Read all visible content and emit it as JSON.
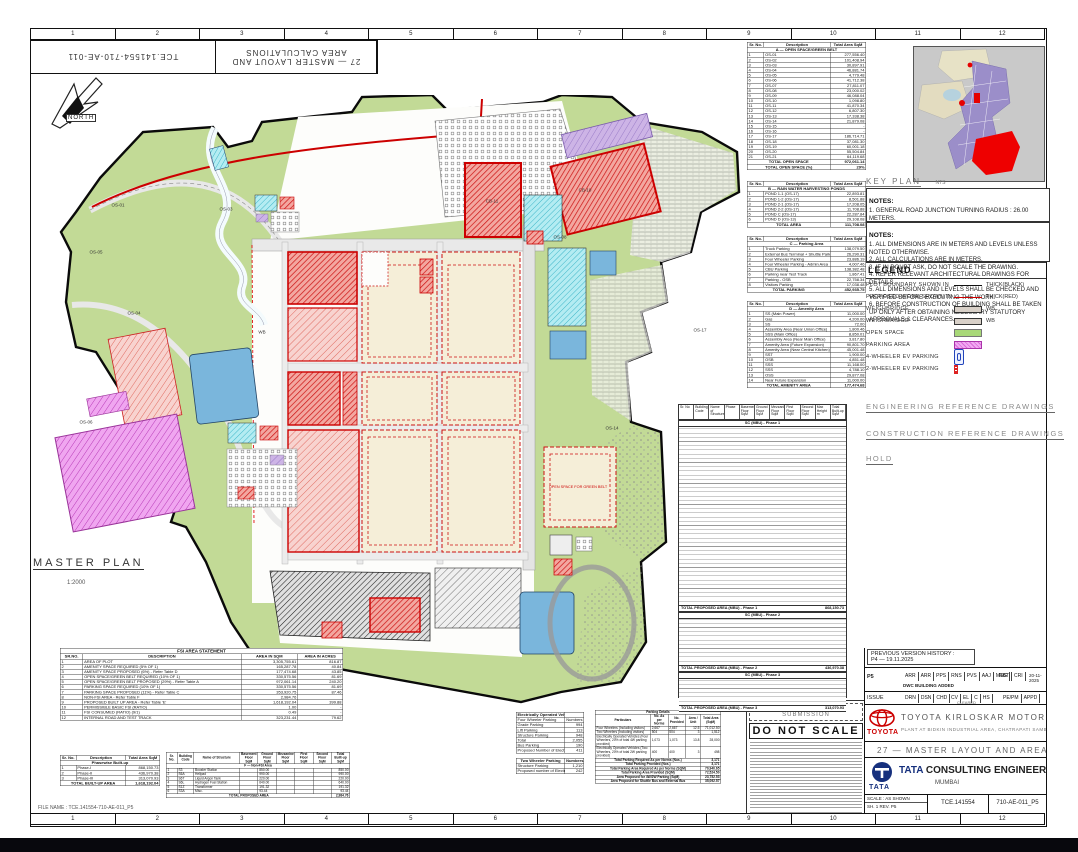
{
  "sheet": {
    "ruler_numbers": [
      "1",
      "2",
      "3",
      "4",
      "5",
      "6",
      "7",
      "8",
      "9",
      "10",
      "11",
      "12"
    ],
    "flip_left": "TCE.141554-710-AE-011",
    "flip_right_line1": "27 — MASTER LAYOUT AND",
    "flip_right_line2": "AREA CALCULATIONS",
    "corner_note": "21.512",
    "north_label": "NORTH"
  },
  "plan": {
    "title": "MASTER PLAN",
    "scale": "1:2000",
    "labels": [
      {
        "t": "OS-01",
        "x": 118,
        "y": 205,
        "c": ""
      },
      {
        "t": "OS-03",
        "x": 226,
        "y": 209,
        "c": ""
      },
      {
        "t": "OS-05",
        "x": 96,
        "y": 252,
        "c": ""
      },
      {
        "t": "OS-04",
        "x": 134,
        "y": 313,
        "c": ""
      },
      {
        "t": "OS-06",
        "x": 86,
        "y": 422,
        "c": ""
      },
      {
        "t": "CB-11",
        "x": 492,
        "y": 201,
        "c": ""
      },
      {
        "t": "CB-10",
        "x": 585,
        "y": 190,
        "c": ""
      },
      {
        "t": "OS-08",
        "x": 560,
        "y": 237,
        "c": ""
      },
      {
        "t": "OS-14",
        "x": 612,
        "y": 428,
        "c": ""
      },
      {
        "t": "OS-17",
        "x": 700,
        "y": 330,
        "c": ""
      },
      {
        "t": "WB",
        "x": 262,
        "y": 332,
        "c": ""
      },
      {
        "t": "OPEN SPACE FOR GREEN BELT",
        "x": 578,
        "y": 487,
        "c": "red"
      }
    ]
  },
  "colors": {
    "open_space": "#a8d878",
    "parking_area": "#ee82ee",
    "proposed_red": "#cc0000",
    "water": "#6ab0d8",
    "plot_beige": "#f5eed8",
    "key_urban": "#9b8ec9"
  },
  "tableA": {
    "head": [
      "Sr. No.",
      "Description",
      "Total Area SqM"
    ],
    "widths": [
      14,
      56,
      30
    ],
    "rows": [
      [
        "§",
        "A — OPEN SPACE/GREEN BELT"
      ],
      [
        "1",
        "OS-01",
        "277,556.40"
      ],
      [
        "2",
        "OS-02",
        "101,408.94"
      ],
      [
        "3",
        "OS-03",
        "30,897.91"
      ],
      [
        "4",
        "OS-04",
        "46,881.74"
      ],
      [
        "5",
        "OS-05",
        "4,779.48"
      ],
      [
        "6",
        "OS-06",
        "41,712.38"
      ],
      [
        "7",
        "OS-07",
        "27,811.07"
      ],
      [
        "8",
        "OS-08",
        "23,000.02"
      ],
      [
        "9",
        "OS-09",
        "46,088.04"
      ],
      [
        "10",
        "OS-10",
        "1,098.80"
      ],
      [
        "11",
        "OS-11",
        "41,870.34"
      ],
      [
        "12",
        "OS-12",
        "6,807.30"
      ],
      [
        "13",
        "OS-13",
        "17,338.38"
      ],
      [
        "14",
        "OS-14",
        "21,879.08"
      ],
      [
        "15",
        "OS-15",
        "-"
      ],
      [
        "16",
        "OS-16",
        "-"
      ],
      [
        "17",
        "OS-17",
        "186,714.71"
      ],
      [
        "18",
        "OS-18",
        "37,081.30"
      ],
      [
        "19",
        "OS-19",
        "60,001.18"
      ],
      [
        "20",
        "OS-20",
        "55,504.84"
      ],
      [
        "21",
        "OS-21",
        "64,119.68"
      ],
      [
        "Σ",
        "TOTAL OPEN SPACE",
        "972,061.14"
      ],
      [
        "Σ",
        "TOTAL OPEN SPACE (%)",
        "29%"
      ]
    ]
  },
  "tableB": {
    "head": [
      "Sr. No.",
      "Description",
      "Total Area SqM"
    ],
    "widths": [
      14,
      56,
      30
    ],
    "rows": [
      [
        "§",
        "B — RAIN WATER HARVESTING PONDS"
      ],
      [
        "1",
        "POND 1-1 (OS-17)",
        "22,893.81"
      ],
      [
        "2",
        "POND 1-2 (OS-17)",
        "8,501.88"
      ],
      [
        "3",
        "POND 2-1 (OS-17)",
        "17,208.05"
      ],
      [
        "4",
        "POND 2-2 (OS-17)",
        "11,708.88"
      ],
      [
        "5",
        "POND C (OS-17)",
        "22,287.84"
      ],
      [
        "6",
        "POND D (OS-13)",
        "29,108.08"
      ],
      [
        "Σ",
        "TOTAL AREA",
        "111,708.08"
      ]
    ]
  },
  "tableC": {
    "head": [
      "Sr. No.",
      "Description",
      "Total Area SqM"
    ],
    "widths": [
      14,
      56,
      30
    ],
    "rows": [
      [
        "§",
        "C — Parking Area"
      ],
      [
        "1",
        "Truck Parking",
        "138,079.50"
      ],
      [
        "2",
        "External Bus Terminal + Shuttle Parking",
        "26,290.31"
      ],
      [
        "3",
        "Four Wheeler Parking",
        "23,886.19"
      ],
      [
        "4",
        "Four Wheeler Parking - Admin Area",
        "4,007.46"
      ],
      [
        "5",
        "CBU Parking",
        "138,382.48"
      ],
      [
        "6",
        "Parking near Test Track",
        "1,867.41"
      ],
      [
        "7",
        "Parking - OSB",
        "22,758.34"
      ],
      [
        "8",
        "Visitors Parking",
        "17,038.48"
      ],
      [
        "Σ",
        "TOTAL PARKING",
        "452,935.75"
      ]
    ]
  },
  "tableD": {
    "head": [
      "Sr. No.",
      "Description",
      "Total Area SqM"
    ],
    "widths": [
      14,
      56,
      30
    ],
    "rows": [
      [
        "§",
        "D — Amenity Area"
      ],
      [
        "1",
        "SS (Main Power)",
        "11,000.00"
      ],
      [
        "2",
        "Gas",
        "4,200.00"
      ],
      [
        "3",
        "SS",
        "72.00"
      ],
      [
        "4",
        "Assembly Area (Near Union Office)",
        "1,800.46"
      ],
      [
        "5",
        "SSS (Main Office)",
        "8,850.01"
      ],
      [
        "6",
        "Assembly Area (Near Main Office)",
        "3,817.80"
      ],
      [
        "7",
        "Amenity Area (Future Expansion)",
        "90,801.70"
      ],
      [
        "8",
        "Amenity Area (Near Central Kitchen)",
        "45,001.48"
      ],
      [
        "9",
        "SST",
        "1,900.00"
      ],
      [
        "10",
        "OSB",
        "4,851.48"
      ],
      [
        "11",
        "SSS",
        "11,168.00"
      ],
      [
        "12",
        "SSS",
        "4,788.10"
      ],
      [
        "13",
        "OSS",
        "29,877.08"
      ],
      [
        "14",
        "Near Future Expansion",
        "11,000.00"
      ],
      [
        "Σ",
        "TOTAL AMENITY AREA",
        "177,474.68"
      ]
    ]
  },
  "fsi": {
    "title": "FSI AREA STATEMENT",
    "head": [
      "SR.NO.",
      "DESCRIPTION",
      "AREA IN SQM",
      "AREA IN ACRES"
    ],
    "widths": [
      8,
      56,
      20,
      16
    ],
    "rows": [
      [
        "1",
        "AREA OF PLOT",
        "3,305,755.61",
        "816.87"
      ],
      [
        "2",
        "AMENITY SPACE REQUIRED (5% OF 1)",
        "165,287.78",
        "40.84"
      ],
      [
        "3",
        "AMENITY SPACE PROPOSED (6%) - Refer Table D",
        "177,474.68",
        "43.85"
      ],
      [
        "4",
        "OPEN SPACE/GREEN BELT REQUIRED (10% OF 1)",
        "330,575.56",
        "81.69"
      ],
      [
        "5",
        "OPEN SPACE/GREEN BELT PROPOSED (29%) - Refer Table A",
        "972,061.14",
        "240.20"
      ],
      [
        "6",
        "PARKING SPACE REQUIRED (10% OF 1)",
        "330,575.56",
        "81.69"
      ],
      [
        "7",
        "PARKING SPACE PROPOSED (11%) - Refer Table C",
        "353,920.75",
        "87.46"
      ],
      [
        "8",
        "NON-FSI AREA - Refer Table F",
        "2,984.76",
        ""
      ],
      [
        "9",
        "PROPOSED BUILT UP AREA - Refer Table 'E'",
        "1,618,192.04",
        "399.88"
      ],
      [
        "10",
        "PERMISSIBLE BASIC FSI (RATIO)",
        "1.00",
        "-"
      ],
      [
        "11",
        "FSI CONSUMED (RATIO) (9/1)",
        "0.49",
        "-"
      ],
      [
        "12",
        "INTERNAL ROAD AND TEST TRACK",
        "323,231.44",
        "79.62"
      ]
    ]
  },
  "phasewise": {
    "head": [
      "Sr. No.",
      "Description",
      "Total Area SqM"
    ],
    "widths": [
      16,
      50,
      34
    ],
    "rows": [
      [
        "§",
        "Phasewise Built-up"
      ],
      [
        "1",
        "Phase-I",
        "868,150.73"
      ],
      [
        "2",
        "Phase-II",
        "436,970.38"
      ],
      [
        "3",
        "Phase-III",
        "313,070.93"
      ],
      [
        "Σ",
        "TOTAL BUILT-UP AREA",
        "1,618,192.04"
      ]
    ]
  },
  "nonfsi": {
    "head": [
      "Sr. No.",
      "Building Code",
      "Name of Structure",
      "Basement Floor SqM",
      "Ground Floor SqM",
      "Mezzanine Floor SqM",
      "First Floor SqM",
      "Second Floor SqM",
      "Total Built-up SqM"
    ],
    "widths": [
      6,
      9,
      25,
      10,
      10,
      10,
      10,
      10,
      10
    ],
    "rows": [
      [
        "§",
        "F — Non-FSI Area"
      ],
      [
        "1",
        "S3",
        "Booster Station",
        "",
        "850.00",
        "",
        "",
        "",
        "850.00"
      ],
      [
        "2",
        "S6A",
        "Helipad",
        "",
        "990.00",
        "",
        "",
        "",
        "990.00"
      ],
      [
        "3",
        "S6T",
        "Liquid Argon Tank",
        "",
        "220.00",
        "",
        "",
        "",
        "220.00"
      ],
      [
        "4",
        "S6L",
        "Hydrogen Fuel Station",
        "",
        "640.00",
        "",
        "",
        "",
        "640.00"
      ],
      [
        "5",
        "S1Z",
        "Transformer",
        "",
        "191.32",
        "",
        "",
        "",
        "191.32"
      ],
      [
        "6",
        "S3A",
        "Misc.",
        "",
        "93.44",
        "",
        "",
        "",
        "93.44"
      ],
      [
        "Σ",
        "TOTAL PROPOSED AREA",
        "2,984.76"
      ]
    ]
  },
  "ev4": {
    "head": [
      "Electrically Operated Vehicles",
      ""
    ],
    "widths": [
      72,
      28
    ],
    "rows": [
      [
        "Four Wheeler Parking",
        "Numbers"
      ],
      [
        "Grade Parking",
        "994"
      ],
      [
        "Lift Parking",
        "113"
      ],
      [
        "Structure Parking",
        "948"
      ],
      [
        "Total",
        "2,055"
      ],
      [
        "Bus Parking",
        "190"
      ],
      [
        "Proposed Number of Electrically Operated Vehicles - 20%",
        "411"
      ]
    ]
  },
  "ev2": {
    "head": [
      "Two Wheeler Parking",
      "Numbers"
    ],
    "widths": [
      72,
      28
    ],
    "rows": [
      [
        "Structure Parking",
        "1,210"
      ],
      [
        "Proposed number of Electrically Operated Vehicles - 20%",
        "242"
      ]
    ]
  },
  "parking_details": {
    "title": "Parking Details",
    "head": [
      "Particulars",
      "No. As per Norms",
      "No. Provided",
      "Area / Unit",
      "Total Area (SqM)"
    ],
    "widths": [
      44,
      14,
      14,
      12,
      16
    ],
    "rows": [
      [
        "Four Wheelers (Including visitors)",
        "2,667",
        "2,667",
        "12.5",
        "71,012.50"
      ],
      [
        "Two Wheelers (Including visitors)",
        "504",
        "504",
        "3",
        "1,512"
      ],
      [
        "Electrically Operated Vehicles (Four Wheelers, 20% of total 4W parking provided)",
        "1,073",
        "1,073",
        "13.8",
        "28,000"
      ],
      [
        "Electrically Operated Vehicles (Two Wheelers, 20% of total 2W parking provided)",
        "400",
        "400",
        "3",
        "498"
      ],
      [
        "Σ",
        "Total Parking Required As per Norms (Nos.)",
        "3,171"
      ],
      [
        "Σ",
        "Total Parking Provided (Nos.)",
        "3,171"
      ],
      [
        "Σ",
        "Total Parking Area Required As per Norms (SQM)",
        "70,940.65"
      ],
      [
        "Σ",
        "Total Parking Area Provided (SQM)",
        "72,524.50"
      ],
      [
        "Σ",
        "Area Proposed for 4W/2W Parking (SqM)",
        "23,752.53"
      ],
      [
        "Σ",
        "Area Proposed for Shuttle Bus and External Bus",
        "35,092.57"
      ]
    ]
  },
  "tableE": {
    "head": [
      "Sr. No",
      "Building Code",
      "Name of Structure",
      "Phase",
      "Basement Floor SqM",
      "Ground Floor SqM",
      "Mezzanine Floor SqM",
      "First Floor SqM",
      "Second Floor SqM",
      "Max Height m",
      "Total Built-up SqM"
    ],
    "sections": [
      {
        "label": "SC (MBU) - Phase 1",
        "total_label": "TOTAL PROPOSED AREA (MBU) - Phase 1",
        "total": "868,150.73",
        "h": 178
      },
      {
        "label": "SC (MBU) - Phase 2",
        "total_label": "TOTAL PROPOSED AREA (MBU) - Phase 2",
        "total": "436,970.38",
        "h": 46
      },
      {
        "label": "SC (MBU) - Phase 3",
        "total_label": "TOTAL PROPOSED AREA (MBU) - Phase 3",
        "total": "313,070.93",
        "h": 26
      }
    ]
  },
  "key_plan": {
    "title": "KEY PLAN",
    "scale": "NTS"
  },
  "notes1": {
    "title": "NOTES:",
    "items": [
      "1.  GENERAL ROAD JUNCTION TURNING RADIUS : 26.00 METERS.",
      "2.  DOCKING / ACCESS TURNING RADIUS : 9.00 METERS.",
      "3.  FLY OVER RCC ROAD AND SLOPE RCC ROAD JUNCTION TURNING RADIUS : 6.00 METERS.",
      "4.  FIRE TENDER ACCESS WAY ROAD WILL BE PROVIDED BETWEEN PRESS SHOP AND WELD SHOP."
    ]
  },
  "notes2": {
    "title": "NOTES:",
    "items": [
      "1.  ALL DIMENSIONS ARE IN METERS AND LEVELS UNLESS NOTED OTHERWISE.",
      "2.  ALL CALCULATIONS ARE IN METERS.",
      "3.  IF IN DOUBT ASK, DO NOT SCALE THE DRAWING.",
      "4.  REFER RELEVANT ARCHITECTURAL DRAWINGS FOR DETAILS.",
      "5.  ALL DIMENSIONS AND LEVELS SHALL BE CHECKED AND VERIFIED BEFORE EXECUTING THE WORK.",
      "6.  BEFORE CONSTRUCTION OF BUILDING SHALL BE TAKEN UP ONLY AFTER OBTAINING NECESSARY STATUTORY APPROVALS & CLEARANCES."
    ]
  },
  "legend": {
    "title": "LEGEND",
    "items": [
      {
        "label": "PLOT BOUNDARY SHOWN IN",
        "swatch": "line-black",
        "note": "THICK(BLACK)"
      },
      {
        "label": "PROPOSED WORK SHOWN IN",
        "swatch": "line-red",
        "note": "THICK(RED)"
      },
      {
        "label": "WEIGHBRIDGE",
        "swatch": "wb",
        "note": "WB"
      },
      {
        "label": "WEIGHBRIDGE",
        "swatch": "wb",
        "note": "WB"
      },
      {
        "label": "OPEN SPACE",
        "swatch": "green",
        "note": ""
      },
      {
        "label": "PARKING AREA",
        "swatch": "magenta",
        "note": ""
      },
      {
        "label": "4-WHEELER EV PARKING",
        "swatch": "ev4",
        "note": ""
      },
      {
        "label": "2-WHEELER EV PARKING",
        "swatch": "ev2",
        "note": ""
      }
    ]
  },
  "refs": {
    "engineering": "ENGINEERING REFERENCE DRAWINGS",
    "construction": "CONSTRUCTION REFERENCE DRAWINGS",
    "hold": "HOLD"
  },
  "stamp": {
    "statutory": "FOR STATUTORY SUBMISSION",
    "do_not_scale": "DO NOT SCALE",
    "file_name": "FILE NAME : TCE.141554-710-AE-011_P5"
  },
  "title_block": {
    "prev_history_1": "PREVIOUS VERSION HISTORY :",
    "prev_history_2": "P4  —  19.11.2025",
    "rev": "P5",
    "rev_note": "DWC BUILDING ADDED",
    "rev_initials": [
      "ARR",
      "ARR",
      "PPS",
      "RNS",
      "PVS",
      "AAJ",
      "MSG"
    ],
    "rev_appr": [
      "RBT",
      "CRI"
    ],
    "rev_date": "20-11-2025",
    "issue_label": "ISSUE",
    "issue_cells": [
      "DRN",
      "DSN",
      "CHD"
    ],
    "disciplines": [
      "CV",
      "EL",
      "C",
      "HS"
    ],
    "cleared": "CLEARED",
    "appr_cells": [
      "PE/PM",
      "APPD"
    ],
    "toyota_word": "TOYOTA",
    "company": "TOYOTA  KIRLOSKAR  MOTOR  PRIVATE  LIMITED",
    "company_sub": "PLANT AT BIDKIN INDUSTRIAL AREA, CHATRAPATI SAMBHAJINAGAR, MAHARASHTRA",
    "drawing_title": "27  —  MASTER  LAYOUT  AND  AREA  CALCULATIONS",
    "tata_word": "TATA",
    "consultant": "CONSULTING  ENGINEERS  LIMITED",
    "city": "MUMBAI",
    "scale_label": "SCALE :  AS SHOWN",
    "scale_sub": "SH. 1  REV. P5",
    "job_no": "TCE.141554",
    "drg_no": "710-AE-011_P5"
  },
  "bottom_left_file": "FILE NAME : TCE.141554-710-AE-011_P5"
}
